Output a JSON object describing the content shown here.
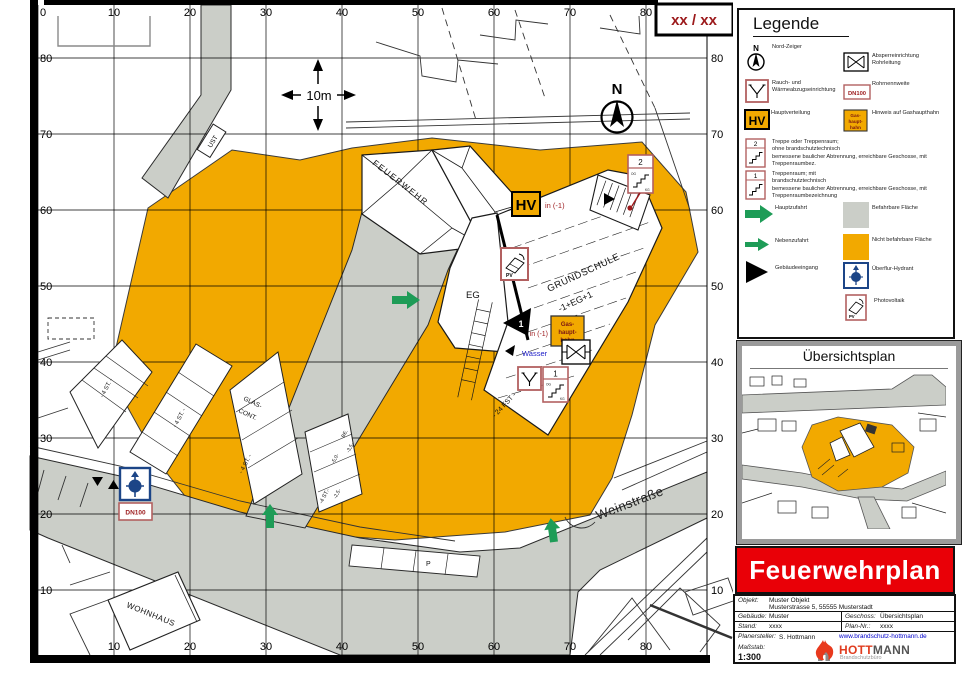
{
  "colors": {
    "orange": "#F2A900",
    "road_gray": "#CBCEC8",
    "green": "#1E9C57",
    "banner_red": "#E90007",
    "dark_red": "#9C1A1C",
    "frame_red": "#B26060",
    "hydrant_blue": "#1C4587",
    "wasser_blue": "#2020C8",
    "link_blue": "#0000CC"
  },
  "map": {
    "plan_ref": "xx / xx",
    "north_label": "N",
    "scale_label": "10m",
    "grid_x": [
      "0",
      "10",
      "20",
      "30",
      "40",
      "50",
      "60",
      "70",
      "80"
    ],
    "grid_y": [
      "80",
      "70",
      "60",
      "50",
      "40",
      "30",
      "20",
      "10"
    ],
    "labels": {
      "feuerwehr": "FEUERWEHR",
      "grundschule": "GRUNDSCHULE",
      "floors": "-1+EG+1",
      "eg": "EG",
      "wohnhaus": "WOHNHAUS",
      "strasse": "Weinstraße",
      "ust": "UST",
      "glas_line1": "GLAS-",
      "glas_line2": "CONT.",
      "fst": "- 24 FST -",
      "p": "P",
      "st_a": "- 4 ST. -",
      "st_b": "- 4 ST. -",
      "st_c": "- 4 ST. -",
      "st_d": "-4 ST.-",
      "dim_50": "-5,0-",
      "dim_35": "-3,5-",
      "dim_25": "-2,5-",
      "be": "BE."
    },
    "symbols": {
      "hv": "HV",
      "hv_note": "in (-1)",
      "gas_l1": "Gas-",
      "gas_l2": "haupt-",
      "gas_l3": "hahn",
      "gas_note": "in (-1)",
      "wasser": "Wasser",
      "dn100": "DN100",
      "pv": "PV",
      "stair1_no": "1",
      "stair2_no": "2",
      "entrance_no": "1",
      "og": "OG",
      "kg": "KG"
    }
  },
  "legend": {
    "title": "Legende",
    "items_left": [
      {
        "label": "Nord-Zeiger"
      },
      {
        "label": "Rauch- und\nWärmeabzugseinrichtung"
      },
      {
        "label": "Hauptverteilung"
      },
      {
        "label": "Treppe oder Treppenraum;\nohne brandschutztechnisch\nbemessene baulicher Abtrennung, erreichbare Geschosse, mit Treppenraumbez."
      },
      {
        "label": "Treppenraum; mit\nbrandschutztechnisch\nbemessene baulicher Abtrennung, erreichbare Geschosse, mit Treppenraumbezeichnung"
      },
      {
        "label": "Hauptzufahrt"
      },
      {
        "label": "Nebenzufahrt"
      },
      {
        "label": "Gebäudeeingang"
      }
    ],
    "items_right": [
      {
        "label": "Absperreinrichtung\nRohrleitung"
      },
      {
        "label": "Rohrnennweite",
        "icon_text": "DN100"
      },
      {
        "label": "Hinweis auf Gashaupthahn"
      },
      {
        "label": "Befahrbare Fläche"
      },
      {
        "label": "Nicht befahrbare Fläche"
      },
      {
        "label": "Überflur-Hydrant"
      },
      {
        "label": "Photovoltaik"
      }
    ]
  },
  "overview": {
    "title": "Übersichtsplan"
  },
  "banner": {
    "text": "Feuerwehrplan"
  },
  "titleblock": {
    "objekt_label": "Objekt:",
    "objekt_value": "Muster Objekt",
    "objekt_value2": "Musterstrasse 5, 55555 Musterstadt",
    "gebaeude_label": "Gebäude:",
    "gebaeude_value": "Muster",
    "geschoss_label": "Geschoss:",
    "geschoss_value": "Übersichtsplan",
    "stand_label": "Stand:",
    "stand_value": "xxxx",
    "plannr_label": "Plan-Nr.:",
    "plannr_value": "xxxx",
    "ersteller_label": "Planersteller:",
    "ersteller_value": "S. Hottmann",
    "website": "www.brandschutz-hottmann.de",
    "massstab_label": "Maßstab:",
    "massstab_value": "1:300",
    "logo_text1": "HOTT",
    "logo_text2": "MANN",
    "logo_sub": "Brandschutzbüro"
  }
}
